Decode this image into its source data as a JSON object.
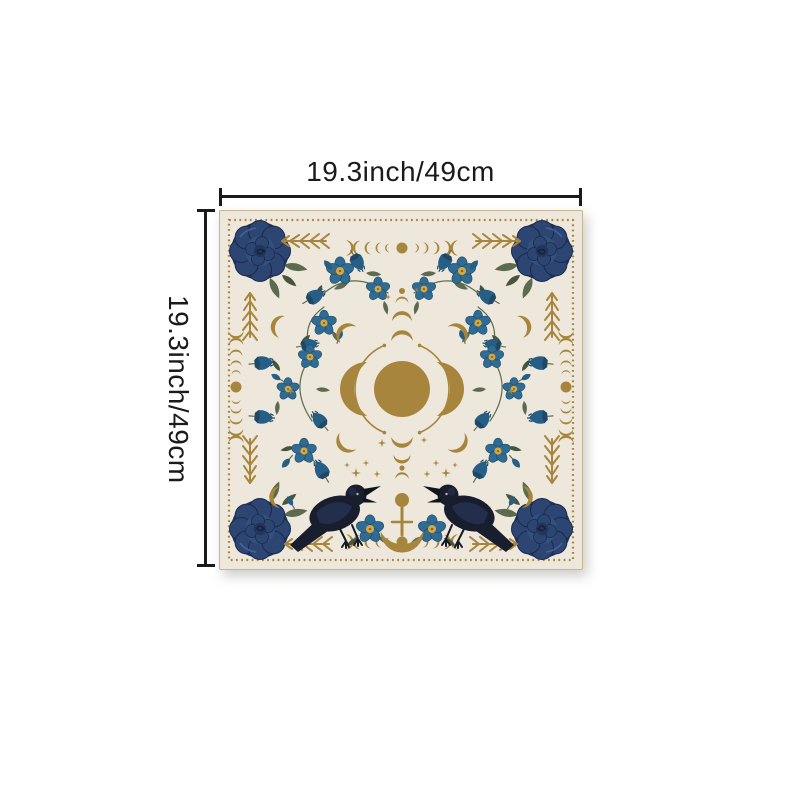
{
  "page": {
    "background": "#ffffff"
  },
  "dimensions": {
    "width_label": "19.3inch/49cm",
    "height_label": "19.3inch/49cm"
  },
  "product": {
    "name": "triple-moon-ravens-altar-cloth",
    "motifs": [
      "triple-moon",
      "moon-phases",
      "crescent-staff",
      "ravens",
      "blue-roses",
      "bluebell-flowers",
      "wildflowers",
      "stars",
      "laurel-sprigs",
      "dotted-border"
    ],
    "colors": {
      "ink": "#1a1a1a",
      "cream": "#EDE8DB",
      "clothEdge": "#C6B693",
      "gold": "#A8853C",
      "navy": "#22365A",
      "navyMid": "#2C4573",
      "navyLight": "#33507F",
      "navyHi": "#4A6AA0",
      "blue": "#2F6B93",
      "blueDeep": "#275E86",
      "blueDark": "#1F4866",
      "green": "#5C6B50",
      "greenDark": "#46563C",
      "yellow": "#D9A83C",
      "raven": "#191E2E",
      "ravenHi": "#2B3D66"
    }
  }
}
